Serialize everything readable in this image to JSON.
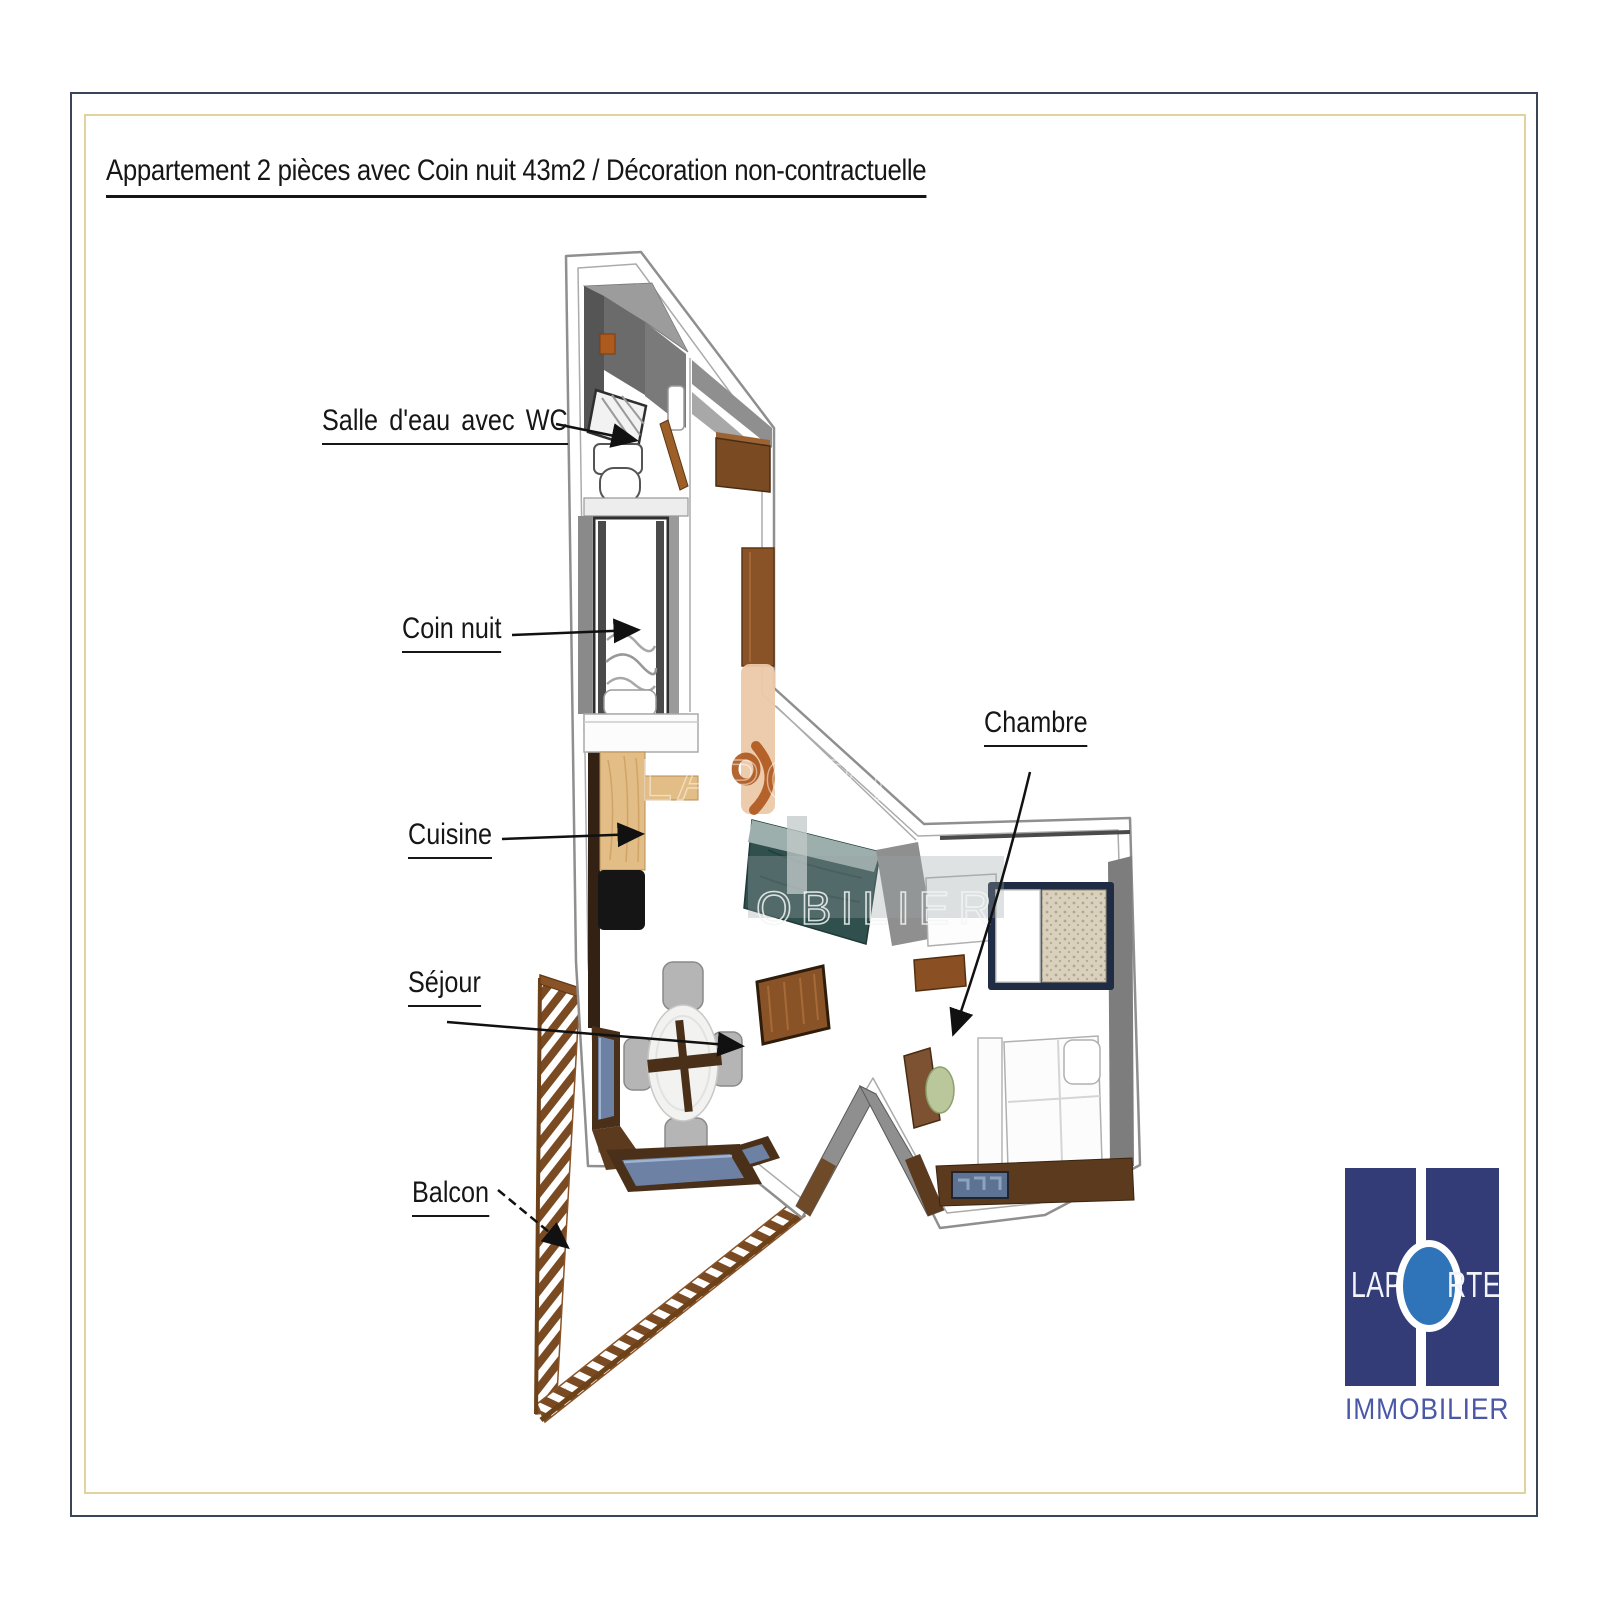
{
  "title": "Appartement 2 pièces avec Coin nuit 43m2 / Décoration non-contractuelle",
  "labels": {
    "salle_deau": "Salle d'eau avec WC",
    "coin_nuit": "Coin nuit",
    "cuisine": "Cuisine",
    "sejour": "Séjour",
    "balcon": "Balcon",
    "chambre": "Chambre"
  },
  "watermark": {
    "line1": "LAPORTE",
    "line2": "OBILIER"
  },
  "logo": {
    "word_left": "LAP",
    "word_right": "RTE",
    "subtitle": "IMMOBILIER"
  },
  "colors": {
    "border_outer": "#3b4559",
    "border_inner": "#e2d29b",
    "logo_navy": "#333c77",
    "logo_circle_blue": "#2f74b8",
    "logo_text_blue": "#4b58a8",
    "wall_gray": "#8f8f8f",
    "wall_dark_gray": "#4a4a4a",
    "wood_dark": "#5b3a1e",
    "wood_mid": "#8a5327",
    "wood_kitchen": "#e2bd85",
    "window_glass": "#6c81a4",
    "sofa_teal": "#30504e",
    "watermark_tan": "#ecc9a9",
    "watermark_orange": "#ad561c"
  }
}
